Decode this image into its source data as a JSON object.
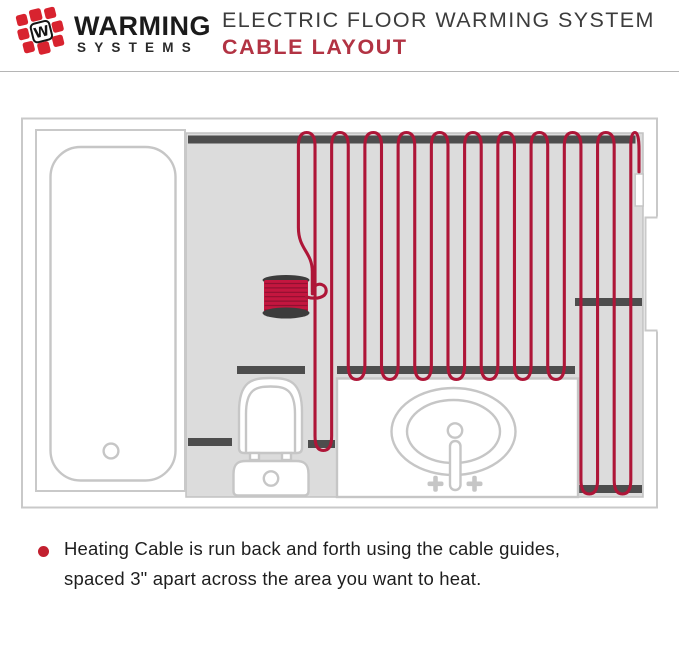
{
  "header": {
    "logo": {
      "brand_line1": "WARMING",
      "brand_line2": "SYSTEMS",
      "tile_letter": "W"
    },
    "title": "ELECTRIC FLOOR WARMING SYSTEM",
    "subtitle": "CABLE LAYOUT"
  },
  "note": {
    "line1": "Heating Cable is run back and forth using the cable guides,",
    "line2": "spaced 3\" apart across the area you want to heat."
  },
  "diagram": {
    "fixtures": [
      "room",
      "bathtub",
      "toilet",
      "vanity-sink",
      "cable-spool",
      "heating-cable",
      "cable-guides",
      "cable-end"
    ],
    "cable_spacing_label": "3\"",
    "colors": {
      "cable": "#ae1638",
      "spool": "#c4163f",
      "spool_shadow": "#911031",
      "guide": "#4d4d4d",
      "floor": "#dcdcdc",
      "fixture_outline": "#c6c6c6",
      "wall": "#c9c9c9",
      "accent": "#b23343",
      "logo": "#d8232f",
      "bullet": "#c2202f"
    }
  }
}
